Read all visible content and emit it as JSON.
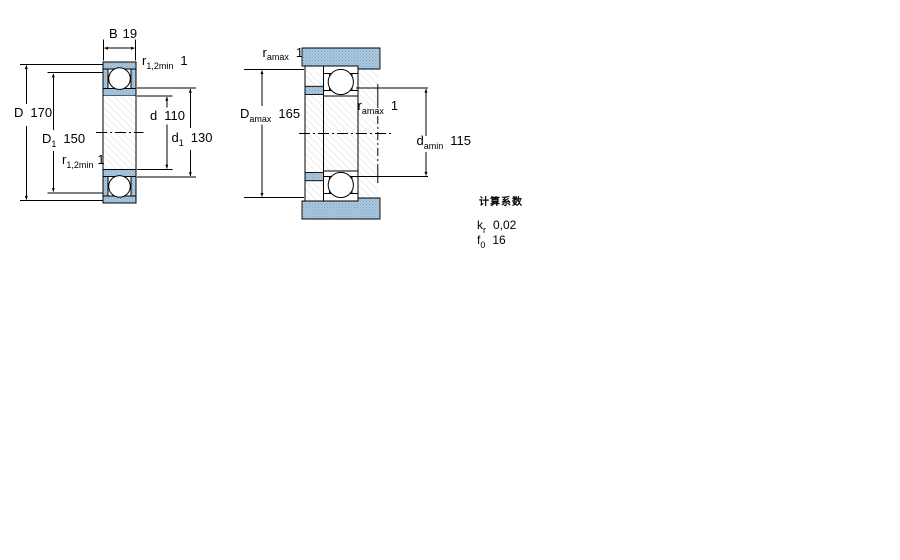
{
  "figure_left": {
    "name": "bearing cross-section with boundary dimensions",
    "labels": {
      "B": {
        "main": "B",
        "value": "19"
      },
      "r_top": {
        "main": "r",
        "sub": "1,2min",
        "value": "1"
      },
      "D": {
        "main": "D",
        "value": "170"
      },
      "D1": {
        "main": "D",
        "sub": "1",
        "value": "150"
      },
      "r_bottom": {
        "main": "r",
        "sub": "1,2min",
        "value": "1"
      },
      "d": {
        "main": "d",
        "value": "110"
      },
      "d1": {
        "main": "d",
        "sub": "1",
        "value": "130"
      }
    }
  },
  "figure_right": {
    "name": "mounted bearing with abutment and fillet dimensions",
    "labels": {
      "ra_top": {
        "main": "r",
        "sub": "amax",
        "value": "1"
      },
      "Da": {
        "main": "D",
        "sub": "amax",
        "value": "165"
      },
      "ra_mid": {
        "main": "r",
        "sub": "amax",
        "value": "1"
      },
      "da": {
        "main": "d",
        "sub": "amin",
        "value": "115"
      }
    }
  },
  "calculation_factors": {
    "heading": "计算系数",
    "rows": [
      {
        "main": "k",
        "sub": "r",
        "value": "0,02"
      },
      {
        "main": "f",
        "sub": "0",
        "value": "16"
      }
    ]
  },
  "colors": {
    "ring_fill": "#a9c7de",
    "ring_dot": "#7fa2bf",
    "line": "#000000",
    "hatch_line": "#ececec",
    "background": "#ffffff"
  }
}
